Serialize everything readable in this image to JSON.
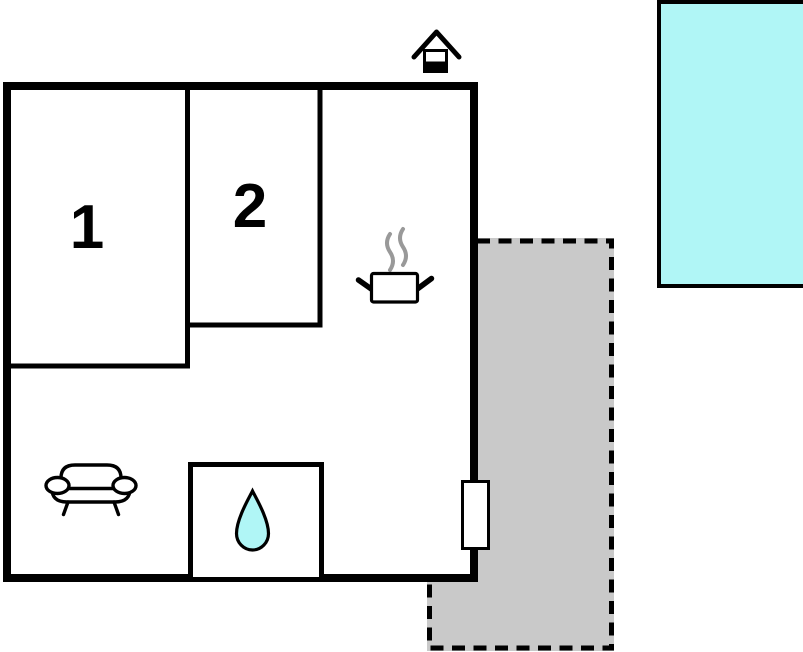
{
  "floor_plan": {
    "type": "vacation-home-floor-plan",
    "room_labels": {
      "room1": "1",
      "room2": "2"
    },
    "features": [
      "main-building",
      "room-1",
      "room-2",
      "bathroom-with-water-drop",
      "kitchen-cooking-pot",
      "sofa",
      "fireplace-chimney",
      "entrance-door",
      "terrace",
      "swimming-pool"
    ]
  },
  "colors": {
    "wall": "#000000",
    "outline": "#000000",
    "water": "#b0f6f6",
    "terrace": "#c9c9c9",
    "steam": "#999999",
    "background": "#ffffff"
  }
}
